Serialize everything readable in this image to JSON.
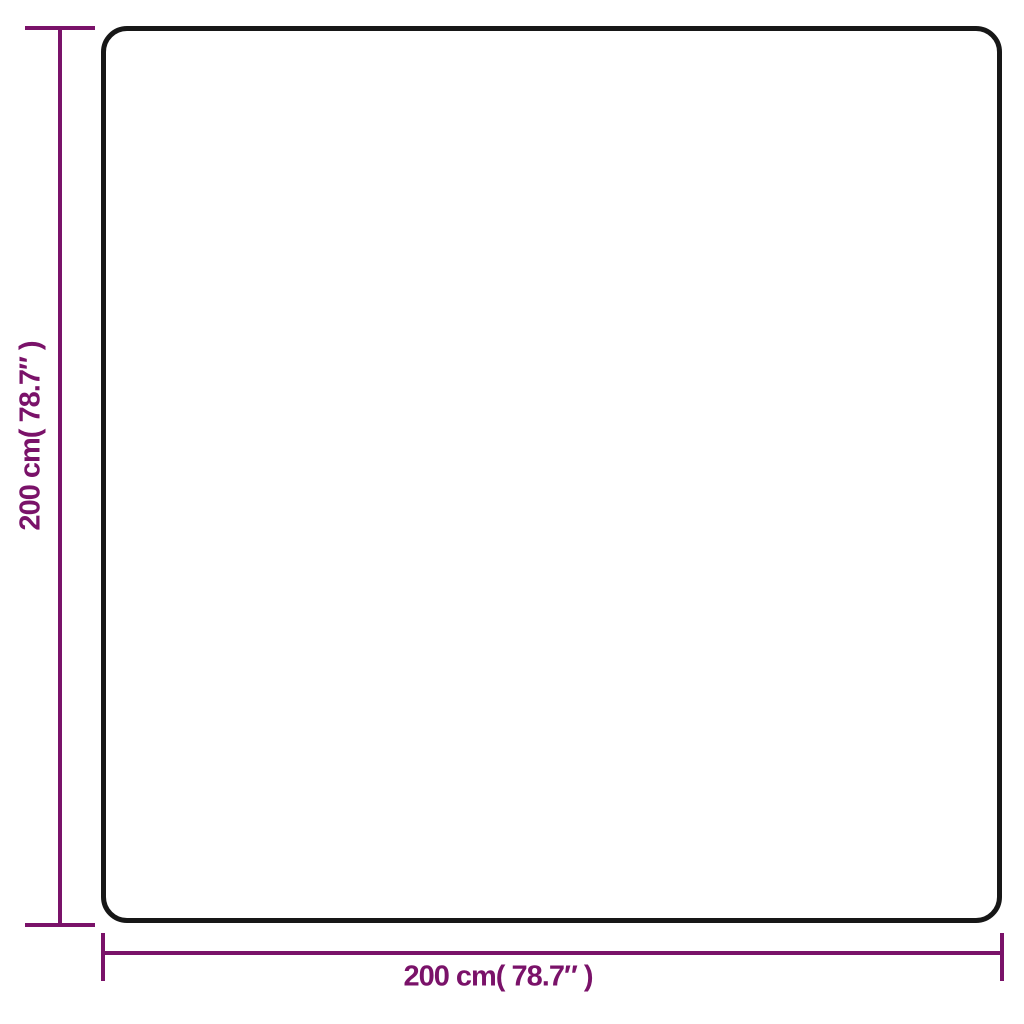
{
  "diagram": {
    "type": "product-dimension-diagram",
    "vertical_dimension": {
      "label": "200 cm( 78.7″ )",
      "value_cm": "200",
      "value_inch": "78.7"
    },
    "horizontal_dimension": {
      "label": "200 cm( 78.7″ )",
      "value_cm": "200",
      "value_inch": "78.7"
    }
  },
  "colors": {
    "background": "#ffffff",
    "outline": "#171717",
    "dimension": "#7a1269"
  }
}
